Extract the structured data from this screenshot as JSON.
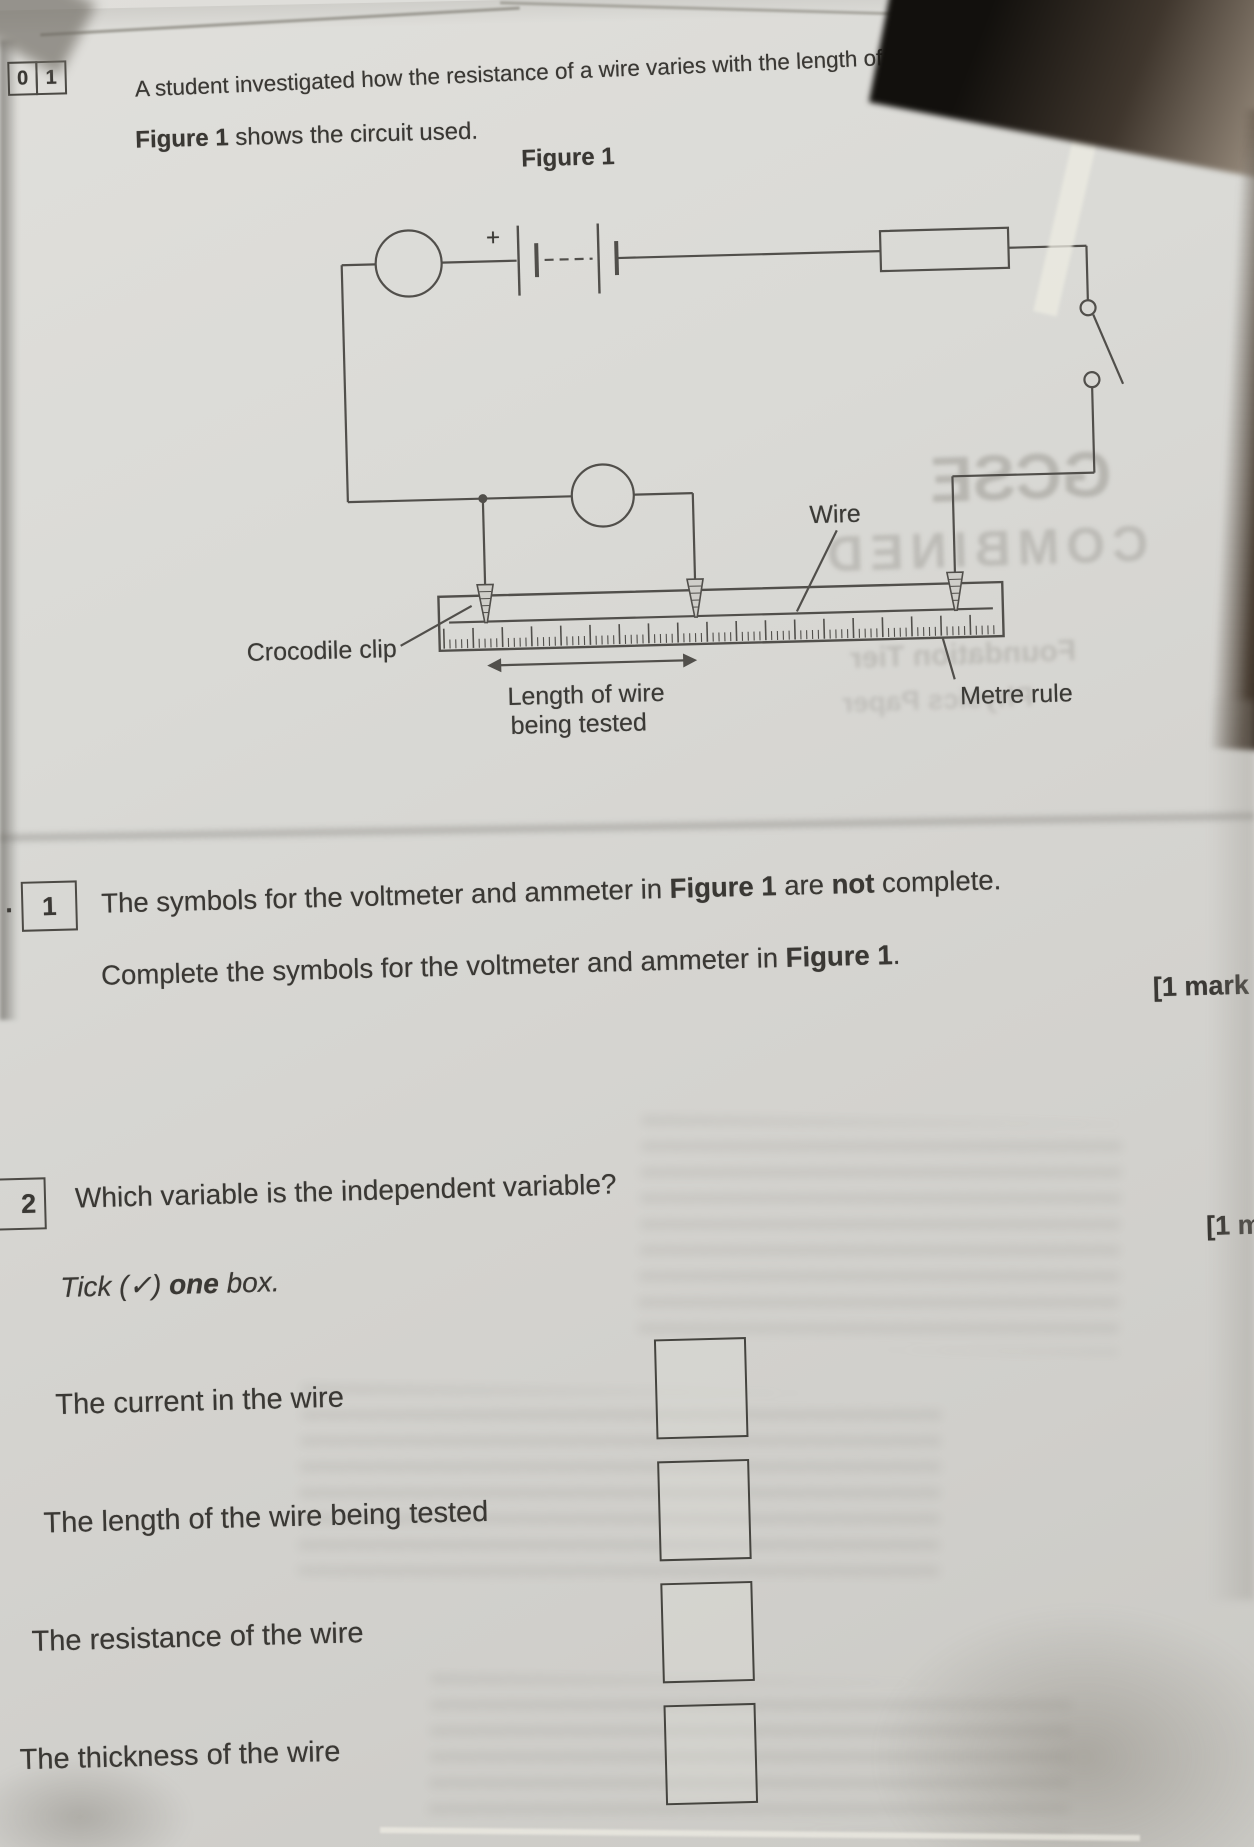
{
  "page": {
    "header": {
      "q_boxes": [
        "0",
        "1"
      ],
      "intro": "A student investigated how the resistance of a wire varies with the length of the wire.",
      "figure_line": {
        "bold": "Figure 1",
        "rest": " shows the circuit used."
      }
    },
    "figure": {
      "title": "Figure 1",
      "plus": "+",
      "wire_label": "Wire",
      "crocodile_label": "Crocodile clip",
      "length_label_1": "Length of wire",
      "length_label_2": "being tested",
      "metre_label": "Metre rule"
    },
    "q1": {
      "prefix": ".",
      "number": "1",
      "line1": {
        "p1": "The symbols for the voltmeter and ammeter in ",
        "b1": "Figure 1",
        "p2": " are ",
        "b2": "not",
        "p3": " complete."
      },
      "line2": {
        "p1": "Complete the symbols for the voltmeter and ammeter in ",
        "b1": "Figure 1",
        "p2": "."
      },
      "marks": "[1 mark"
    },
    "q2": {
      "number": "2",
      "question": "Which variable is the independent variable?",
      "marks": "[1 ma",
      "tick_line": {
        "p1": "Tick (",
        "check": "✓",
        "p2": ") ",
        "b1": "one",
        "p3": " box."
      },
      "options": [
        "The current in the wire",
        "The length of the wire being tested",
        "The resistance of the wire",
        "The thickness of the wire"
      ]
    },
    "watermarks": {
      "w1": "GCSE",
      "w2": "COMBINED",
      "w3": "Foundation Tier",
      "w4": "Physics Paper"
    }
  }
}
